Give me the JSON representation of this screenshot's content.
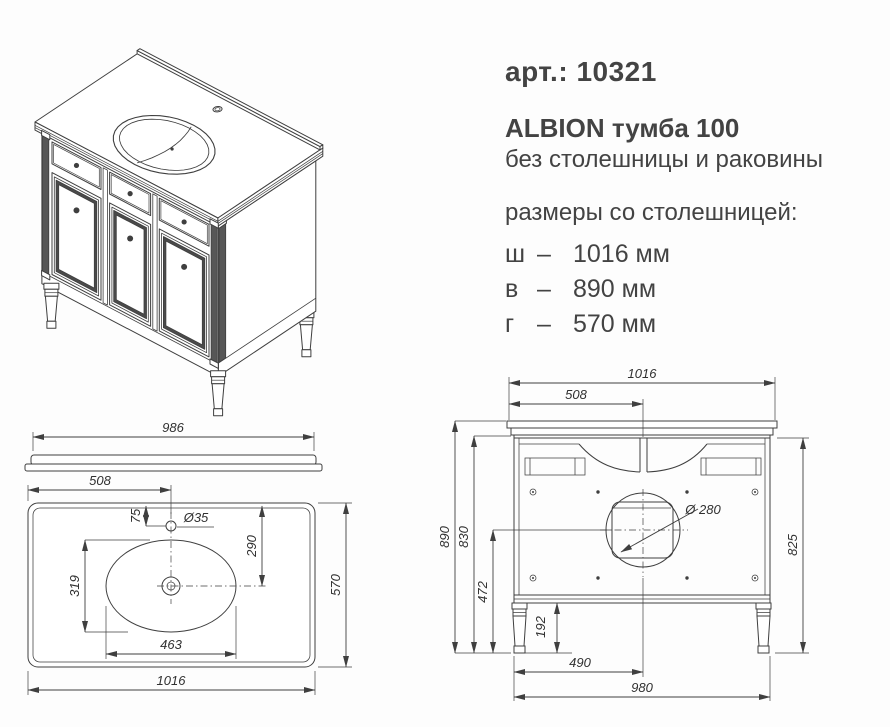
{
  "page": {
    "background": "#fdfdfd",
    "line_color": "#3f3f3f",
    "text_color": "#434343"
  },
  "product": {
    "article_label": "арт.: 10321",
    "title": "ALBION тумба 100",
    "subtitle": "без столешницы и раковины",
    "dims_heading": "размеры со столешницей:",
    "dash": "–",
    "dimensions": [
      {
        "key": "ш",
        "value": "1016 мм"
      },
      {
        "key": "в",
        "value": "890 мм"
      },
      {
        "key": "г",
        "value": "570 мм"
      }
    ]
  },
  "top_view": {
    "dims": {
      "countertop_edge_width": "986",
      "faucet_offset_left": "508",
      "faucet_offset_back": "75",
      "faucet_hole_dia": "Ø35",
      "drain_offset_back": "290",
      "bowl_depth": "319",
      "bowl_width": "463",
      "countertop_depth": "570",
      "countertop_width": "1016"
    }
  },
  "back_view": {
    "dims": {
      "countertop_width": "1016",
      "center_offset_top": "508",
      "total_height": "890",
      "body_height": "830",
      "drain_hole_height": "472",
      "leg_height": "192",
      "drain_hole_dia": "Ø 280",
      "side_height": "825",
      "center_offset_bottom": "490",
      "body_width": "980"
    }
  }
}
